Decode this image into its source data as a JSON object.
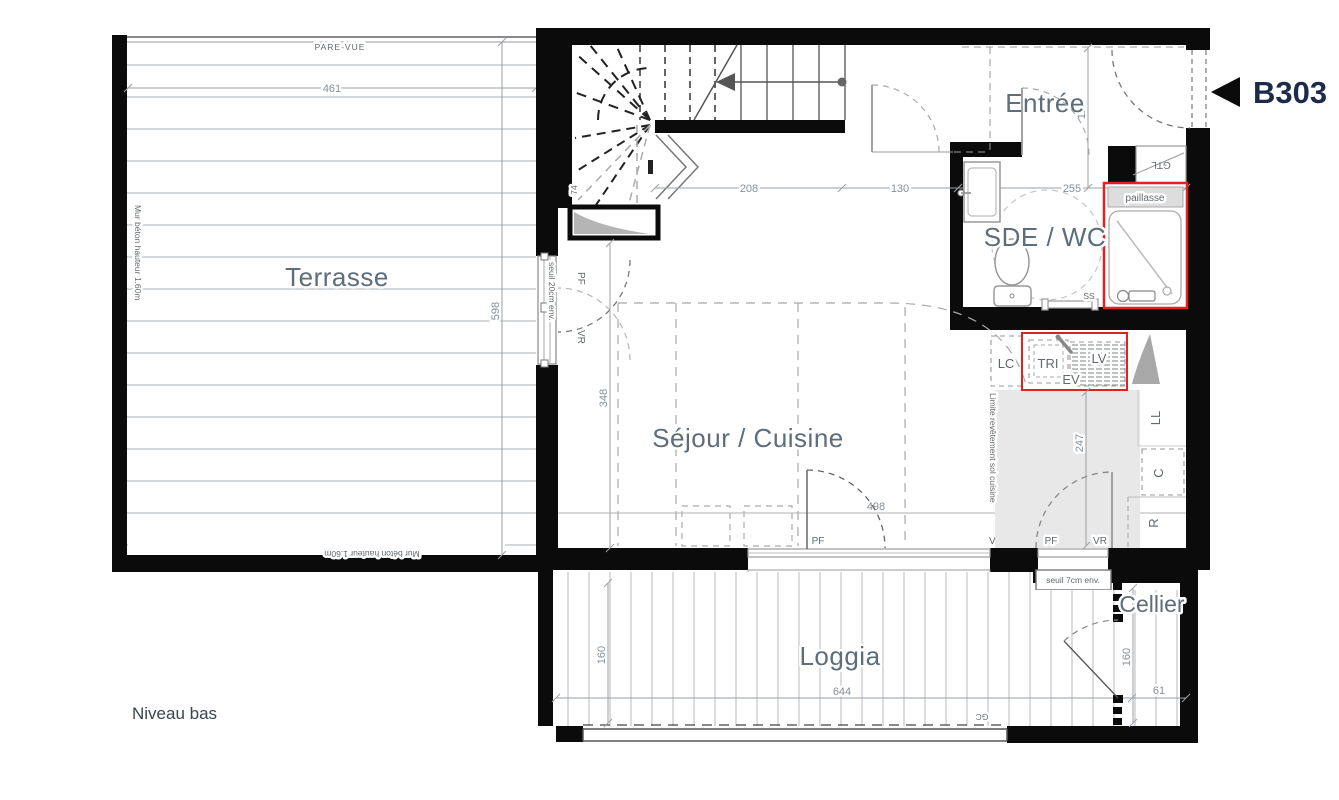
{
  "unit": {
    "id": "B303"
  },
  "level": {
    "label": "Niveau bas"
  },
  "rooms": {
    "terrasse": "Terrasse",
    "sejour": "Séjour / Cuisine",
    "entree": "Entrée",
    "sde": "SDE / WC",
    "loggia": "Loggia",
    "cellier": "Cellier"
  },
  "labels": {
    "pare_vue": "PARE-VUE",
    "mur_beton": "Mur béton hauteur 1.60m",
    "seuil20": "seuil 20cm env.",
    "seuil7": "seuil 7cm env.",
    "limite": "Limite revêtement sol cuisine",
    "paillasse": "paillasse",
    "gtl": "GTL",
    "gc": "GC",
    "ss": "SS",
    "lc": "LC",
    "tri": "TRI",
    "ev": "EV",
    "lv": "LV",
    "ll": "LL",
    "c": "C",
    "r": "R",
    "pf": "PF",
    "vr": "VR"
  },
  "dims": {
    "terrasse_w": "461",
    "terrasse_h": "598",
    "stair": "74",
    "entry_a": "208",
    "entry_b": "130",
    "entry_c": "255",
    "entry_d": "122",
    "sejour_h": "348",
    "sejour_w": "498",
    "cuisine_h": "247",
    "loggia_w": "644",
    "loggia_h": "160",
    "cellier_h": "160",
    "cellier_w": "61"
  },
  "colors": {
    "accent_red": "#e5211d",
    "wall": "#0b0b0b",
    "room_label": "#5d6d79",
    "unit_label": "#1d2a4a"
  }
}
